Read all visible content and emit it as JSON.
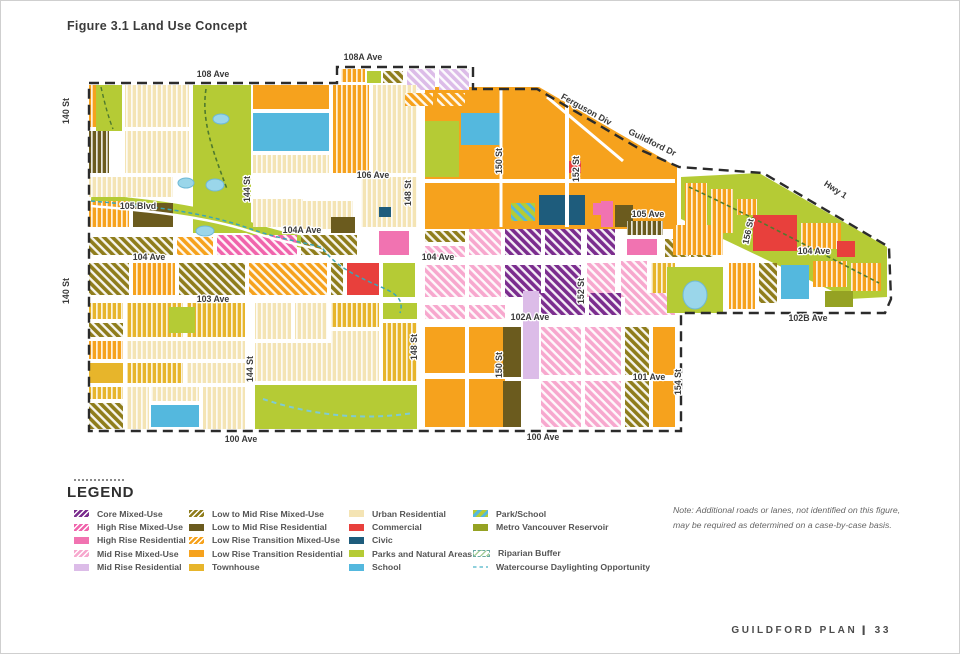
{
  "title": "Figure 3.1 Land Use Concept",
  "map": {
    "palette": {
      "cm": "#7B2D8E",
      "hm": "#F064AC",
      "hr": "#F173B1",
      "mm": "#F7A8CE",
      "mr": "#DCBCE8",
      "lmm": "#8F7D1C",
      "lmr": "#6B5B1E",
      "ltm": "#F6A21D",
      "ltr": "#F6A21D",
      "th": "#E7B52B",
      "ur": "#F4E4B4",
      "co": "#E8403C",
      "cv": "#1E5C7C",
      "pk": "#B5CB35",
      "sc": "#54B8DE",
      "rv": "#95A223",
      "rb": "#A8CF9B",
      "wd": "#8FD0DC",
      "boundary": "#2b2b2b"
    },
    "street_labels": [
      {
        "text": "108 Ave",
        "x": 212,
        "y": 76,
        "rot": 0
      },
      {
        "text": "108A Ave",
        "x": 362,
        "y": 59,
        "rot": 0
      },
      {
        "text": "Ferguson Div",
        "x": 584,
        "y": 111,
        "rot": 29
      },
      {
        "text": "Guildford Dr",
        "x": 650,
        "y": 144,
        "rot": 26
      },
      {
        "text": "Hwy 1",
        "x": 833,
        "y": 191,
        "rot": 33
      },
      {
        "text": "140 St",
        "x": 68,
        "y": 110,
        "rot": -90
      },
      {
        "text": "140 St",
        "x": 68,
        "y": 290,
        "rot": -90
      },
      {
        "text": "144 St",
        "x": 249,
        "y": 188,
        "rot": -90
      },
      {
        "text": "144 St",
        "x": 252,
        "y": 368,
        "rot": -90
      },
      {
        "text": "148 St",
        "x": 410,
        "y": 192,
        "rot": -90
      },
      {
        "text": "148 St",
        "x": 416,
        "y": 346,
        "rot": -90
      },
      {
        "text": "150 St",
        "x": 501,
        "y": 160,
        "rot": -90
      },
      {
        "text": "150 St",
        "x": 501,
        "y": 364,
        "rot": -90
      },
      {
        "text": "152 St",
        "x": 578,
        "y": 168,
        "rot": -90
      },
      {
        "text": "152 St",
        "x": 583,
        "y": 290,
        "rot": -90
      },
      {
        "text": "154 St",
        "x": 680,
        "y": 381,
        "rot": -90
      },
      {
        "text": "156 St",
        "x": 750,
        "y": 231,
        "rot": -78
      },
      {
        "text": "106 Ave",
        "x": 372,
        "y": 177,
        "rot": 0
      },
      {
        "text": "105 Blvd",
        "x": 137,
        "y": 208,
        "rot": 0
      },
      {
        "text": "105 Ave",
        "x": 647,
        "y": 216,
        "rot": 0
      },
      {
        "text": "104A Ave",
        "x": 301,
        "y": 232,
        "rot": 0
      },
      {
        "text": "104 Ave",
        "x": 148,
        "y": 259,
        "rot": 0
      },
      {
        "text": "104 Ave",
        "x": 437,
        "y": 259,
        "rot": 0
      },
      {
        "text": "104 Ave",
        "x": 813,
        "y": 253,
        "rot": 0
      },
      {
        "text": "103 Ave",
        "x": 212,
        "y": 301,
        "rot": 0
      },
      {
        "text": "102A Ave",
        "x": 529,
        "y": 319,
        "rot": 0
      },
      {
        "text": "101 Ave",
        "x": 648,
        "y": 379,
        "rot": 0
      },
      {
        "text": "102B Ave",
        "x": 807,
        "y": 320,
        "rot": 0
      },
      {
        "text": "100 Ave",
        "x": 240,
        "y": 441,
        "rot": 0
      },
      {
        "text": "100 Ave",
        "x": 542,
        "y": 439,
        "rot": 0
      }
    ],
    "parcels": [
      [
        340,
        68,
        24,
        13,
        "ltr",
        "r"
      ],
      [
        366,
        70,
        14,
        12,
        "pk",
        ""
      ],
      [
        382,
        70,
        20,
        12,
        "lmm",
        "h"
      ],
      [
        406,
        68,
        28,
        21,
        "mr",
        "h"
      ],
      [
        438,
        68,
        30,
        21,
        "mr",
        "h"
      ],
      [
        88,
        84,
        20,
        42,
        "ltr",
        "r"
      ],
      [
        88,
        130,
        20,
        42,
        "lmr",
        "r"
      ],
      [
        95,
        84,
        26,
        46,
        "pk",
        ""
      ],
      [
        124,
        84,
        64,
        42,
        "ur",
        "r"
      ],
      [
        124,
        130,
        64,
        42,
        "ur",
        "r"
      ],
      [
        192,
        84,
        58,
        148,
        "pk",
        ""
      ],
      [
        252,
        84,
        76,
        24,
        "ltr",
        ""
      ],
      [
        252,
        112,
        76,
        38,
        "sc",
        ""
      ],
      [
        252,
        154,
        76,
        18,
        "ur",
        "r"
      ],
      [
        332,
        84,
        36,
        88,
        "ltr",
        "r"
      ],
      [
        372,
        84,
        44,
        88,
        "ur",
        "r"
      ],
      [
        404,
        92,
        28,
        13,
        "ltm",
        "h"
      ],
      [
        436,
        92,
        28,
        13,
        "ltm",
        "h"
      ],
      [
        424,
        120,
        34,
        56,
        "pk",
        ""
      ],
      [
        460,
        112,
        40,
        32,
        "sc",
        ""
      ],
      [
        538,
        194,
        46,
        30,
        "cv",
        ""
      ],
      [
        510,
        202,
        24,
        18,
        "ps",
        ""
      ],
      [
        564,
        160,
        16,
        12,
        "co",
        ""
      ],
      [
        600,
        200,
        12,
        26,
        "hr",
        ""
      ],
      [
        88,
        176,
        84,
        20,
        "ur",
        "r"
      ],
      [
        88,
        200,
        40,
        26,
        "ltr",
        "r"
      ],
      [
        132,
        202,
        40,
        24,
        "lmr",
        ""
      ],
      [
        252,
        198,
        50,
        28,
        "ur",
        "r"
      ],
      [
        288,
        200,
        64,
        28,
        "ur",
        "r"
      ],
      [
        360,
        176,
        56,
        50,
        "ur",
        "r"
      ],
      [
        330,
        216,
        24,
        16,
        "lmr",
        ""
      ],
      [
        378,
        206,
        12,
        10,
        "cv",
        ""
      ],
      [
        88,
        236,
        84,
        18,
        "lmm",
        "h"
      ],
      [
        176,
        236,
        36,
        18,
        "ltm",
        "h"
      ],
      [
        216,
        234,
        80,
        20,
        "hm",
        "h"
      ],
      [
        300,
        234,
        56,
        20,
        "lmm",
        "h"
      ],
      [
        378,
        230,
        30,
        24,
        "hr",
        ""
      ],
      [
        424,
        230,
        40,
        11,
        "lmm",
        "h"
      ],
      [
        424,
        245,
        40,
        11,
        "mm",
        "h"
      ],
      [
        468,
        228,
        32,
        26,
        "mm",
        "h"
      ],
      [
        504,
        228,
        36,
        26,
        "cm",
        "h"
      ],
      [
        544,
        228,
        36,
        26,
        "cm",
        "h"
      ],
      [
        586,
        228,
        28,
        26,
        "cm",
        "h"
      ],
      [
        592,
        202,
        18,
        12,
        "hr",
        ""
      ],
      [
        614,
        204,
        18,
        22,
        "lmr",
        ""
      ],
      [
        626,
        220,
        36,
        14,
        "lmr",
        "r"
      ],
      [
        626,
        238,
        30,
        16,
        "hr",
        ""
      ],
      [
        664,
        238,
        24,
        18,
        "lmm",
        "h"
      ],
      [
        690,
        240,
        22,
        16,
        "lmm",
        "h"
      ],
      [
        424,
        264,
        40,
        32,
        "mm",
        "h"
      ],
      [
        468,
        264,
        32,
        32,
        "mm",
        "h"
      ],
      [
        504,
        264,
        36,
        32,
        "cm",
        "h"
      ],
      [
        544,
        264,
        36,
        32,
        "cm",
        "h"
      ],
      [
        586,
        262,
        28,
        34,
        "mm",
        "h"
      ],
      [
        620,
        260,
        26,
        36,
        "mm",
        "h"
      ],
      [
        650,
        262,
        24,
        34,
        "th",
        "r"
      ],
      [
        88,
        262,
        40,
        32,
        "lmm",
        "h"
      ],
      [
        132,
        262,
        42,
        32,
        "ltr",
        "r"
      ],
      [
        178,
        262,
        66,
        32,
        "lmm",
        "h"
      ],
      [
        248,
        262,
        78,
        32,
        "ltm",
        "h"
      ],
      [
        330,
        262,
        12,
        32,
        "lmm",
        "h"
      ],
      [
        346,
        262,
        32,
        32,
        "co",
        ""
      ],
      [
        382,
        262,
        32,
        34,
        "pk",
        ""
      ],
      [
        382,
        302,
        34,
        16,
        "pk",
        ""
      ],
      [
        424,
        304,
        40,
        14,
        "mm",
        "h"
      ],
      [
        468,
        304,
        36,
        14,
        "mm",
        "h"
      ],
      [
        540,
        292,
        44,
        22,
        "cm",
        "h"
      ],
      [
        588,
        292,
        32,
        22,
        "cm",
        "h"
      ],
      [
        624,
        292,
        50,
        22,
        "mm",
        "h"
      ],
      [
        88,
        302,
        34,
        16,
        "th",
        "r"
      ],
      [
        88,
        322,
        34,
        14,
        "lmm",
        "h"
      ],
      [
        88,
        340,
        34,
        18,
        "ltr",
        "r"
      ],
      [
        88,
        362,
        34,
        20,
        "th",
        ""
      ],
      [
        88,
        386,
        34,
        12,
        "th",
        "r"
      ],
      [
        88,
        402,
        34,
        26,
        "lmm",
        "h"
      ],
      [
        126,
        302,
        56,
        34,
        "th",
        "r"
      ],
      [
        186,
        302,
        58,
        34,
        "th",
        "r"
      ],
      [
        168,
        306,
        26,
        26,
        "pk",
        ""
      ],
      [
        126,
        340,
        118,
        18,
        "ur",
        "r"
      ],
      [
        126,
        362,
        56,
        20,
        "th",
        "r"
      ],
      [
        186,
        362,
        58,
        20,
        "ur",
        "r"
      ],
      [
        126,
        386,
        22,
        42,
        "ur",
        "r"
      ],
      [
        150,
        386,
        48,
        14,
        "ur",
        "r"
      ],
      [
        150,
        404,
        48,
        22,
        "sc",
        ""
      ],
      [
        202,
        386,
        42,
        42,
        "ur",
        "r"
      ],
      [
        254,
        302,
        36,
        36,
        "ur",
        "r"
      ],
      [
        294,
        302,
        32,
        36,
        "ur",
        "r"
      ],
      [
        330,
        302,
        48,
        24,
        "th",
        "r"
      ],
      [
        330,
        330,
        48,
        50,
        "ur",
        "r"
      ],
      [
        382,
        322,
        34,
        58,
        "th",
        "r"
      ],
      [
        254,
        342,
        76,
        38,
        "ur",
        "r"
      ],
      [
        254,
        384,
        162,
        44,
        "pk",
        ""
      ],
      [
        424,
        326,
        40,
        46,
        "ltr",
        ""
      ],
      [
        468,
        326,
        36,
        46,
        "ltr",
        ""
      ],
      [
        424,
        378,
        40,
        48,
        "ltr",
        ""
      ],
      [
        468,
        378,
        36,
        48,
        "ltr",
        ""
      ],
      [
        502,
        326,
        18,
        50,
        "lmr",
        ""
      ],
      [
        502,
        380,
        18,
        46,
        "lmr",
        ""
      ],
      [
        522,
        290,
        16,
        88,
        "mr",
        ""
      ],
      [
        540,
        326,
        40,
        48,
        "mm",
        "h"
      ],
      [
        584,
        326,
        36,
        48,
        "mm",
        "h"
      ],
      [
        540,
        380,
        40,
        46,
        "mm",
        "h"
      ],
      [
        584,
        380,
        36,
        46,
        "mm",
        "h"
      ],
      [
        624,
        326,
        24,
        48,
        "lmm",
        "h"
      ],
      [
        624,
        380,
        24,
        46,
        "lmm",
        "h"
      ],
      [
        652,
        326,
        22,
        48,
        "ltr",
        ""
      ],
      [
        652,
        380,
        22,
        46,
        "ltr",
        ""
      ],
      [
        684,
        182,
        22,
        44,
        "ltr",
        "r"
      ],
      [
        710,
        188,
        22,
        44,
        "ltr",
        "r"
      ],
      [
        736,
        198,
        20,
        16,
        "ltr",
        "r"
      ],
      [
        752,
        214,
        44,
        36,
        "co",
        ""
      ],
      [
        800,
        222,
        40,
        26,
        "ltr",
        "r"
      ],
      [
        836,
        240,
        18,
        16,
        "co",
        ""
      ],
      [
        672,
        224,
        50,
        30,
        "ltr",
        "r"
      ],
      [
        666,
        266,
        56,
        46,
        "pk",
        ""
      ],
      [
        728,
        262,
        26,
        46,
        "ltr",
        "r"
      ],
      [
        758,
        262,
        18,
        40,
        "lmm",
        "h"
      ],
      [
        780,
        264,
        28,
        34,
        "sc",
        ""
      ],
      [
        812,
        260,
        34,
        26,
        "ltr",
        "r"
      ],
      [
        824,
        290,
        28,
        16,
        "rv",
        ""
      ],
      [
        850,
        262,
        30,
        28,
        "ltr",
        "r"
      ]
    ],
    "ponds": [
      [
        185,
        182,
        8,
        5
      ],
      [
        214,
        184,
        9,
        6
      ],
      [
        204,
        230,
        9,
        5
      ],
      [
        220,
        118,
        8,
        5
      ],
      [
        694,
        294,
        12,
        14
      ]
    ]
  },
  "legend": {
    "title": "LEGEND",
    "columns": [
      {
        "left": 73,
        "items": [
          {
            "label": "Core Mixed-Use",
            "key": "cm",
            "style": "h"
          },
          {
            "label": "High Rise Mixed-Use",
            "key": "hm",
            "style": "h"
          },
          {
            "label": "High Rise Residential",
            "key": "hr",
            "style": "s"
          },
          {
            "label": "Mid Rise Mixed-Use",
            "key": "mm",
            "style": "h"
          },
          {
            "label": "Mid Rise Residential",
            "key": "mr",
            "style": "s"
          }
        ]
      },
      {
        "left": 188,
        "items": [
          {
            "label": "Low to Mid Rise Mixed-Use",
            "key": "lmm",
            "style": "h"
          },
          {
            "label": "Low to Mid Rise Residential",
            "key": "lmr",
            "style": "s"
          },
          {
            "label": "Low Rise Transition Mixed-Use",
            "key": "ltm",
            "style": "h"
          },
          {
            "label": "Low Rise Transition Residential",
            "key": "ltr",
            "style": "s"
          },
          {
            "label": "Townhouse",
            "key": "th",
            "style": "s"
          }
        ]
      },
      {
        "left": 348,
        "items": [
          {
            "label": "Urban Residential",
            "key": "ur",
            "style": "s"
          },
          {
            "label": "Commercial",
            "key": "co",
            "style": "s"
          },
          {
            "label": "Civic",
            "key": "cv",
            "style": "s"
          },
          {
            "label": "Parks and Natural Areas",
            "key": "pk",
            "style": "s"
          },
          {
            "label": "School",
            "key": "sc",
            "style": "s"
          }
        ]
      },
      {
        "left": 472,
        "items": [
          {
            "label": "Park/School",
            "key": "ps",
            "style": "split"
          },
          {
            "label": "Metro Vancouver Reservoir",
            "key": "rv",
            "style": "s"
          },
          {
            "label": "Riparian Buffer",
            "key": "rb",
            "style": "rb",
            "gap": true
          },
          {
            "label": "Watercourse Daylighting Opportunity",
            "key": "wd",
            "style": "wd"
          }
        ]
      }
    ]
  },
  "note": {
    "line1": "Note: Additional roads or lanes, not identified on this figure,",
    "line2": "may be required as determined on a case-by-case basis."
  },
  "footer": {
    "label": "GUILDFORD PLAN",
    "separator": "|",
    "page": "33"
  }
}
